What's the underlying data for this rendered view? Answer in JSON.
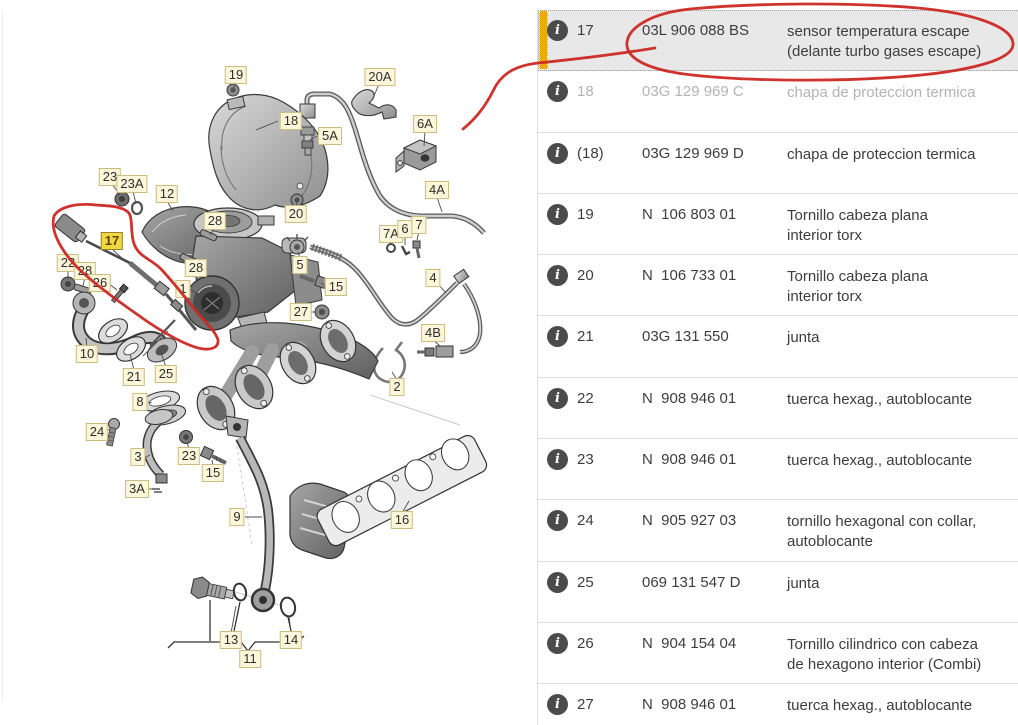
{
  "diagram": {
    "label_bg": "#fcf6da",
    "label_highlight_bg": "#f1d83e",
    "highlighted_item": "17",
    "labels": [
      {
        "t": "19",
        "x": 236,
        "y": 75
      },
      {
        "t": "20A",
        "x": 380,
        "y": 77
      },
      {
        "t": "18",
        "x": 291,
        "y": 121
      },
      {
        "t": "5A",
        "x": 330,
        "y": 136
      },
      {
        "t": "6A",
        "x": 425,
        "y": 124
      },
      {
        "t": "23",
        "x": 110,
        "y": 177
      },
      {
        "t": "23A",
        "x": 132,
        "y": 184
      },
      {
        "t": "12",
        "x": 167,
        "y": 194
      },
      {
        "t": "4A",
        "x": 437,
        "y": 190
      },
      {
        "t": "28",
        "x": 215,
        "y": 221
      },
      {
        "t": "17",
        "x": 112,
        "y": 241,
        "hl": true
      },
      {
        "t": "20",
        "x": 296,
        "y": 214
      },
      {
        "t": "7A",
        "x": 391,
        "y": 234
      },
      {
        "t": "6",
        "x": 405,
        "y": 229
      },
      {
        "t": "7",
        "x": 419,
        "y": 225
      },
      {
        "t": "22",
        "x": 68,
        "y": 263
      },
      {
        "t": "28",
        "x": 85,
        "y": 271
      },
      {
        "t": "26",
        "x": 100,
        "y": 283
      },
      {
        "t": "28",
        "x": 196,
        "y": 268
      },
      {
        "t": "5",
        "x": 300,
        "y": 265
      },
      {
        "t": "1",
        "x": 183,
        "y": 289
      },
      {
        "t": "15",
        "x": 336,
        "y": 287
      },
      {
        "t": "27",
        "x": 301,
        "y": 312
      },
      {
        "t": "4",
        "x": 433,
        "y": 278
      },
      {
        "t": "10",
        "x": 87,
        "y": 354
      },
      {
        "t": "21",
        "x": 134,
        "y": 377
      },
      {
        "t": "25",
        "x": 166,
        "y": 374
      },
      {
        "t": "4B",
        "x": 433,
        "y": 333
      },
      {
        "t": "2",
        "x": 397,
        "y": 387
      },
      {
        "t": "8",
        "x": 140,
        "y": 402
      },
      {
        "t": "24",
        "x": 97,
        "y": 432
      },
      {
        "t": "3",
        "x": 138,
        "y": 457
      },
      {
        "t": "23",
        "x": 189,
        "y": 456
      },
      {
        "t": "15",
        "x": 213,
        "y": 473
      },
      {
        "t": "3A",
        "x": 137,
        "y": 489
      },
      {
        "t": "9",
        "x": 237,
        "y": 517
      },
      {
        "t": "16",
        "x": 402,
        "y": 520
      },
      {
        "t": "13",
        "x": 231,
        "y": 640
      },
      {
        "t": "14",
        "x": 291,
        "y": 640
      },
      {
        "t": "11",
        "x": 250,
        "y": 659
      }
    ]
  },
  "annotations": {
    "color": "#cc2823",
    "shapes": [
      "circle-around-table-row-17",
      "loop-around-diagram-part-17",
      "leader-line-to-diagram"
    ]
  },
  "table": {
    "info_glyph": "i",
    "selection_bar_color": "#edaa00",
    "selected_row_bg": "#e8e8e8",
    "rows": [
      {
        "num": "17",
        "part": "03L 906 088 BS",
        "desc": "sensor temperatura escape\n(delante turbo gases escape)",
        "selected": true,
        "dimmed": false
      },
      {
        "num": "18",
        "part": "03G 129 969 C",
        "desc": "chapa de proteccion termica",
        "selected": false,
        "dimmed": true
      },
      {
        "num": "(18)",
        "part": "03G 129 969 D",
        "desc": "chapa de proteccion termica",
        "selected": false,
        "dimmed": false
      },
      {
        "num": "19",
        "part": "N  106 803 01",
        "desc": "Tornillo cabeza plana\ninterior torx",
        "selected": false,
        "dimmed": false
      },
      {
        "num": "20",
        "part": "N  106 733 01",
        "desc": "Tornillo cabeza plana\ninterior torx",
        "selected": false,
        "dimmed": false
      },
      {
        "num": "21",
        "part": "03G 131 550",
        "desc": "junta",
        "selected": false,
        "dimmed": false
      },
      {
        "num": "22",
        "part": "N  908 946 01",
        "desc": "tuerca hexag., autoblocante",
        "selected": false,
        "dimmed": false
      },
      {
        "num": "23",
        "part": "N  908 946 01",
        "desc": "tuerca hexag., autoblocante",
        "selected": false,
        "dimmed": false
      },
      {
        "num": "24",
        "part": "N  905 927 03",
        "desc": "tornillo hexagonal con collar,\nautoblocante",
        "selected": false,
        "dimmed": false
      },
      {
        "num": "25",
        "part": "069 131 547 D",
        "desc": "junta",
        "selected": false,
        "dimmed": false
      },
      {
        "num": "26",
        "part": "N  904 154 04",
        "desc": "Tornillo cilindrico con cabeza\nde hexagono interior (Combi)",
        "selected": false,
        "dimmed": false
      },
      {
        "num": "27",
        "part": "N  908 946 01",
        "desc": "tuerca hexag., autoblocante",
        "selected": false,
        "dimmed": false
      }
    ]
  }
}
